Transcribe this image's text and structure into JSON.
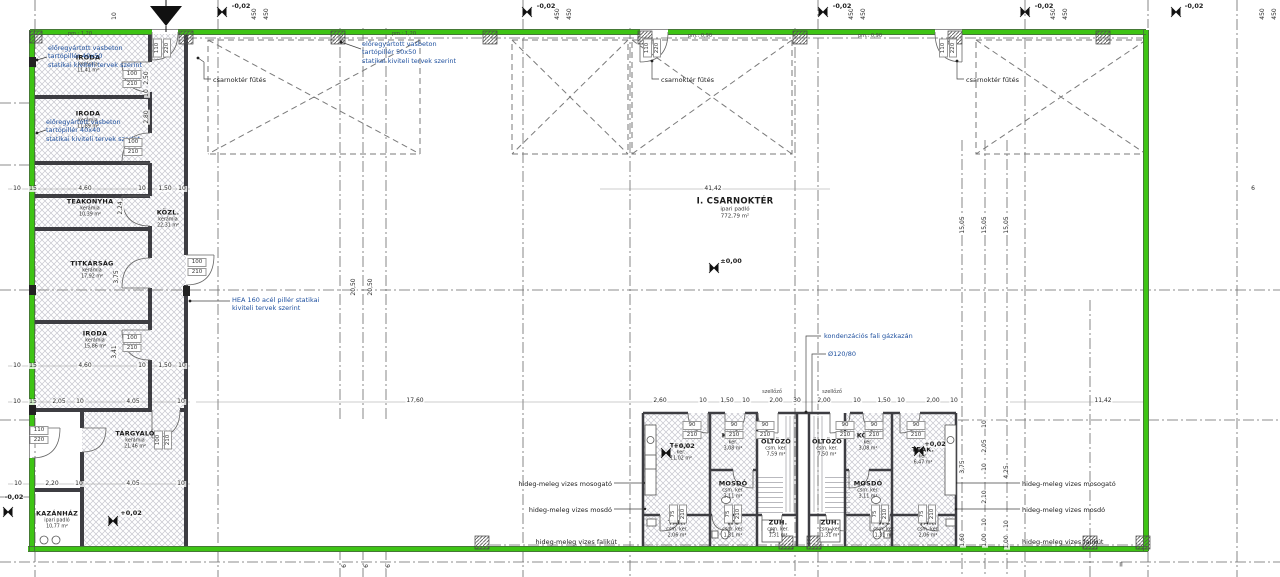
{
  "colors": {
    "outline_green": "#3ec414",
    "wall_dark": "#3d3d42",
    "note_blue": "#1d4f9e",
    "text": "#1c1c1c",
    "hatch": "#c3c3cb"
  },
  "rooms": [
    {
      "name": "IRODA",
      "finish": "kerámia",
      "area": "11,41 m²",
      "x": 88,
      "y": 64
    },
    {
      "name": "IRODA",
      "finish": "kerámia",
      "area": "11,89 m²",
      "x": 88,
      "y": 120
    },
    {
      "name": "TEAKONYHA",
      "finish": "kerámia",
      "area": "10,39 m²",
      "x": 90,
      "y": 208
    },
    {
      "name": "KÖZL.",
      "finish": "kerámia",
      "area": "22,31 m²",
      "x": 168,
      "y": 219
    },
    {
      "name": "TITKÁRSÁG",
      "finish": "kerámia",
      "area": "17,92 m²",
      "x": 92,
      "y": 270
    },
    {
      "name": "IRODA",
      "finish": "kerámia",
      "area": "15,86 m²",
      "x": 95,
      "y": 340
    },
    {
      "name": "TÁRGYALÓ",
      "finish": "kerámia",
      "area": "21,46 m²",
      "x": 135,
      "y": 440
    },
    {
      "name": "KAZÁNHÁZ",
      "finish": "ipari padló",
      "area": "10,77 m²",
      "x": 57,
      "y": 520
    },
    {
      "name": "I. CSARNOKTÉR",
      "finish": "ipari padló",
      "area": "772,79 m²",
      "x": 735,
      "y": 208,
      "big": true
    },
    {
      "name": "TEAK.",
      "finish": "ker.",
      "area": "11,02 m²",
      "x": 681,
      "y": 452
    },
    {
      "name": "KÖZL.",
      "finish": "ker.",
      "area": "3,08 m²",
      "x": 733,
      "y": 442
    },
    {
      "name": "ÖLTÖZŐ",
      "finish": "csm. ker.",
      "area": "7,59 m²",
      "x": 776,
      "y": 448
    },
    {
      "name": "ÖLTÖZŐ",
      "finish": "csm. ker.",
      "area": "7,50 m²",
      "x": 827,
      "y": 448
    },
    {
      "name": "KÖZL.",
      "finish": "ker.",
      "area": "3,08 m²",
      "x": 868,
      "y": 442
    },
    {
      "name": "TEAK.",
      "finish": "ker.",
      "area": "6,47 m²",
      "x": 923,
      "y": 456
    },
    {
      "name": "MOSDÓ",
      "finish": "csm. ker.",
      "area": "3,11 m²",
      "x": 733,
      "y": 490
    },
    {
      "name": "MOSDÓ",
      "finish": "csm. ker.",
      "area": "3,11 m²",
      "x": 868,
      "y": 490
    },
    {
      "name": "TAK.",
      "finish": "csm. ker.",
      "area": "2,06 m²",
      "x": 677,
      "y": 529
    },
    {
      "name": "WC",
      "finish": "csm. ker.",
      "area": "1,31 m²",
      "x": 733,
      "y": 529
    },
    {
      "name": "ZUH.",
      "finish": "csm. ker.",
      "area": "1,31 m²",
      "x": 778,
      "y": 529
    },
    {
      "name": "ZUH.",
      "finish": "csm. ker.",
      "area": "1,31 m²",
      "x": 830,
      "y": 529
    },
    {
      "name": "WC",
      "finish": "csm. ker.",
      "area": "1,31 m²",
      "x": 884,
      "y": 529
    },
    {
      "name": "TAK.",
      "finish": "csm. ker.",
      "area": "2,06 m²",
      "x": 928,
      "y": 529
    }
  ],
  "notes": [
    {
      "t": "előregyártott vasbeton\ntartópillér 40x50\nstatikai kiviteli tervek szerint",
      "x": 48,
      "y": 44,
      "c": "blue"
    },
    {
      "t": "előregyártott vasbeton\ntartópillér 40x40\nstatikai kiviteli tervek szerint",
      "x": 46,
      "y": 118,
      "c": "blue"
    },
    {
      "t": "előregyártott vasbeton\ntartópillér 50x50\nstatikai kiviteli tervek szerint",
      "x": 362,
      "y": 40,
      "c": "blue"
    },
    {
      "t": "HEA 160 acél pillér statikai\nkiviteli tervek szerint",
      "x": 232,
      "y": 296,
      "c": "blue"
    },
    {
      "t": "kondenzációs fali gázkazán",
      "x": 824,
      "y": 332,
      "c": "blue"
    },
    {
      "t": "Ø120/80",
      "x": 828,
      "y": 350,
      "c": "blue"
    },
    {
      "t": "csarnoktér fűtés",
      "x": 213,
      "y": 76,
      "c": "black"
    },
    {
      "t": "csarnoktér fűtés",
      "x": 661,
      "y": 76,
      "c": "black"
    },
    {
      "t": "csarnoktér fűtés",
      "x": 966,
      "y": 76,
      "c": "black"
    },
    {
      "t": "hideg-meleg vizes mosogató",
      "x": 480,
      "y": 480,
      "c": "black",
      "w": 132,
      "a": "right"
    },
    {
      "t": "hideg-meleg vizes mosdó",
      "x": 480,
      "y": 506,
      "c": "black",
      "w": 132,
      "a": "right"
    },
    {
      "t": "hideg-meleg vizes falikút",
      "x": 522,
      "y": 538,
      "c": "black",
      "w": 95,
      "a": "right"
    },
    {
      "t": "hideg-meleg vizes mosogató",
      "x": 1022,
      "y": 480,
      "c": "black"
    },
    {
      "t": "hideg-meleg vizes mosdó",
      "x": 1022,
      "y": 506,
      "c": "black"
    },
    {
      "t": "hideg-meleg vizes falikút",
      "x": 1022,
      "y": 538,
      "c": "black"
    }
  ],
  "dims": [
    {
      "t": "10",
      "x": 17,
      "y": 189
    },
    {
      "t": "15",
      "x": 33,
      "y": 189
    },
    {
      "t": "4,60",
      "x": 85,
      "y": 189
    },
    {
      "t": "10",
      "x": 142,
      "y": 189
    },
    {
      "t": "1,50",
      "x": 165,
      "y": 189
    },
    {
      "t": "10",
      "x": 182,
      "y": 189
    },
    {
      "t": "41,42",
      "x": 713,
      "y": 189
    },
    {
      "t": "6",
      "x": 1253,
      "y": 189
    },
    {
      "t": "10",
      "x": 17,
      "y": 366
    },
    {
      "t": "15",
      "x": 33,
      "y": 366
    },
    {
      "t": "4,60",
      "x": 85,
      "y": 366
    },
    {
      "t": "10",
      "x": 142,
      "y": 366
    },
    {
      "t": "1,50",
      "x": 165,
      "y": 366
    },
    {
      "t": "10",
      "x": 182,
      "y": 366
    },
    {
      "t": "10",
      "x": 17,
      "y": 402
    },
    {
      "t": "15",
      "x": 33,
      "y": 402
    },
    {
      "t": "2,05",
      "x": 59,
      "y": 402
    },
    {
      "t": "10",
      "x": 80,
      "y": 402
    },
    {
      "t": "4,05",
      "x": 133,
      "y": 402
    },
    {
      "t": "10",
      "x": 181,
      "y": 402
    },
    {
      "t": "10",
      "x": 18,
      "y": 484
    },
    {
      "t": "2,20",
      "x": 52,
      "y": 484
    },
    {
      "t": "10",
      "x": 79,
      "y": 484
    },
    {
      "t": "4,05",
      "x": 133,
      "y": 484
    },
    {
      "t": "10",
      "x": 181,
      "y": 484
    },
    {
      "t": "17,60",
      "x": 415,
      "y": 401
    },
    {
      "t": "11,42",
      "x": 1103,
      "y": 401
    },
    {
      "t": "2,60",
      "x": 660,
      "y": 401
    },
    {
      "t": "10",
      "x": 703,
      "y": 401
    },
    {
      "t": "1,50",
      "x": 727,
      "y": 401
    },
    {
      "t": "10",
      "x": 746,
      "y": 401
    },
    {
      "t": "2,00",
      "x": 776,
      "y": 401
    },
    {
      "t": "30",
      "x": 797,
      "y": 401
    },
    {
      "t": "2,00",
      "x": 824,
      "y": 401
    },
    {
      "t": "10",
      "x": 857,
      "y": 401
    },
    {
      "t": "1,50",
      "x": 884,
      "y": 401
    },
    {
      "t": "10",
      "x": 901,
      "y": 401
    },
    {
      "t": "2,00",
      "x": 933,
      "y": 401
    },
    {
      "t": "10",
      "x": 954,
      "y": 401
    },
    {
      "t": "2,50",
      "x": 147,
      "y": 78,
      "r": 1
    },
    {
      "t": "10",
      "x": 147,
      "y": 93,
      "r": 1
    },
    {
      "t": "2,80",
      "x": 147,
      "y": 117,
      "r": 1
    },
    {
      "t": "2,24",
      "x": 121,
      "y": 208,
      "r": 1
    },
    {
      "t": "3,75",
      "x": 117,
      "y": 277,
      "r": 1
    },
    {
      "t": "3,41",
      "x": 115,
      "y": 352,
      "r": 1
    },
    {
      "t": "10",
      "x": 115,
      "y": 16,
      "r": 1
    },
    {
      "t": "20,50",
      "x": 354,
      "y": 287,
      "r": 1
    },
    {
      "t": "20,50",
      "x": 371,
      "y": 287,
      "r": 1
    },
    {
      "t": "15,05",
      "x": 963,
      "y": 225,
      "r": 1
    },
    {
      "t": "15,05",
      "x": 985,
      "y": 225,
      "r": 1
    },
    {
      "t": "15,05",
      "x": 1007,
      "y": 225,
      "r": 1
    },
    {
      "t": "3,75",
      "x": 963,
      "y": 467,
      "r": 1
    },
    {
      "t": "1,60",
      "x": 963,
      "y": 540,
      "r": 1
    },
    {
      "t": "10",
      "x": 985,
      "y": 424,
      "r": 1
    },
    {
      "t": "2,05",
      "x": 985,
      "y": 446,
      "r": 1
    },
    {
      "t": "10",
      "x": 985,
      "y": 467,
      "r": 1
    },
    {
      "t": "2,10",
      "x": 985,
      "y": 497,
      "r": 1
    },
    {
      "t": "10",
      "x": 985,
      "y": 522,
      "r": 1
    },
    {
      "t": "1,00",
      "x": 985,
      "y": 540,
      "r": 1
    },
    {
      "t": "4,25",
      "x": 1007,
      "y": 472,
      "r": 1
    },
    {
      "t": "10",
      "x": 1007,
      "y": 524,
      "r": 1
    },
    {
      "t": "1,00",
      "x": 1007,
      "y": 542,
      "r": 1
    },
    {
      "t": "450",
      "x": 255,
      "y": 14,
      "r": 1
    },
    {
      "t": "450",
      "x": 267,
      "y": 14,
      "r": 1
    },
    {
      "t": "450",
      "x": 558,
      "y": 14,
      "r": 1
    },
    {
      "t": "450",
      "x": 570,
      "y": 14,
      "r": 1
    },
    {
      "t": "450",
      "x": 852,
      "y": 14,
      "r": 1
    },
    {
      "t": "450",
      "x": 864,
      "y": 14,
      "r": 1
    },
    {
      "t": "450",
      "x": 1054,
      "y": 14,
      "r": 1
    },
    {
      "t": "450",
      "x": 1066,
      "y": 14,
      "r": 1
    },
    {
      "t": "450",
      "x": 1263,
      "y": 14,
      "r": 1
    },
    {
      "t": "450",
      "x": 1275,
      "y": 14,
      "r": 1
    },
    {
      "t": "6",
      "x": 345,
      "y": 566,
      "r": 1
    },
    {
      "t": "6",
      "x": 367,
      "y": 566,
      "r": 1
    },
    {
      "t": "6",
      "x": 389,
      "y": 566,
      "r": 1
    }
  ],
  "door_tags": [
    {
      "a": "100",
      "b": "210",
      "x": 132,
      "y": 79
    },
    {
      "a": "100",
      "b": "210",
      "x": 133,
      "y": 147
    },
    {
      "a": "100",
      "b": "210",
      "x": 197,
      "y": 267
    },
    {
      "a": "100",
      "b": "210",
      "x": 132,
      "y": 343
    },
    {
      "a": "110",
      "b": "220",
      "x": 39,
      "y": 435
    },
    {
      "a": "100",
      "b": "210",
      "x": 163,
      "y": 440,
      "r": 1
    },
    {
      "a": "110",
      "b": "220",
      "x": 162,
      "y": 48,
      "r": 1
    },
    {
      "a": "110",
      "b": "220",
      "x": 652,
      "y": 48,
      "r": 1
    },
    {
      "a": "110",
      "b": "220",
      "x": 948,
      "y": 48,
      "r": 1
    },
    {
      "a": "90",
      "b": "210",
      "x": 692,
      "y": 430
    },
    {
      "a": "90",
      "b": "210",
      "x": 734,
      "y": 430
    },
    {
      "a": "90",
      "b": "210",
      "x": 765,
      "y": 430
    },
    {
      "a": "90",
      "b": "210",
      "x": 845,
      "y": 430
    },
    {
      "a": "90",
      "b": "210",
      "x": 874,
      "y": 430
    },
    {
      "a": "90",
      "b": "210",
      "x": 916,
      "y": 430
    },
    {
      "a": "75",
      "b": "210",
      "x": 678,
      "y": 514,
      "r": 1
    },
    {
      "a": "75",
      "b": "210",
      "x": 733,
      "y": 514,
      "r": 1
    },
    {
      "a": "75",
      "b": "210",
      "x": 880,
      "y": 514,
      "r": 1
    },
    {
      "a": "75",
      "b": "210",
      "x": 927,
      "y": 514,
      "r": 1
    }
  ],
  "levels": [
    {
      "t": "±0,00",
      "x": 731,
      "y": 261
    },
    {
      "t": "+0,02",
      "x": 131,
      "y": 513
    },
    {
      "t": "+0,02",
      "x": 684,
      "y": 446
    },
    {
      "t": "+0,02",
      "x": 935,
      "y": 444
    },
    {
      "t": "-0,02",
      "x": 14,
      "y": 497
    },
    {
      "t": "-0,02",
      "x": 241,
      "y": 6
    },
    {
      "t": "-0,02",
      "x": 546,
      "y": 6
    },
    {
      "t": "-0,02",
      "x": 842,
      "y": 6
    },
    {
      "t": "-0,02",
      "x": 1044,
      "y": 6
    },
    {
      "t": "-0,02",
      "x": 1194,
      "y": 6
    }
  ],
  "misc": [
    {
      "t": "szellőző",
      "x": 772,
      "y": 392,
      "s": 1
    },
    {
      "t": "szellőző",
      "x": 832,
      "y": 392,
      "s": 1
    },
    {
      "t": "pm.: 1,20",
      "x": 80,
      "y": 34,
      "s": 1
    },
    {
      "t": "pm.: 1,20",
      "x": 404,
      "y": 34,
      "s": 1
    },
    {
      "t": "pm.: 0,90",
      "x": 700,
      "y": 36,
      "s": 1
    },
    {
      "t": "pm.: 0,90",
      "x": 870,
      "y": 36,
      "s": 1
    },
    {
      "t": "II",
      "x": 1121,
      "y": 565
    }
  ]
}
